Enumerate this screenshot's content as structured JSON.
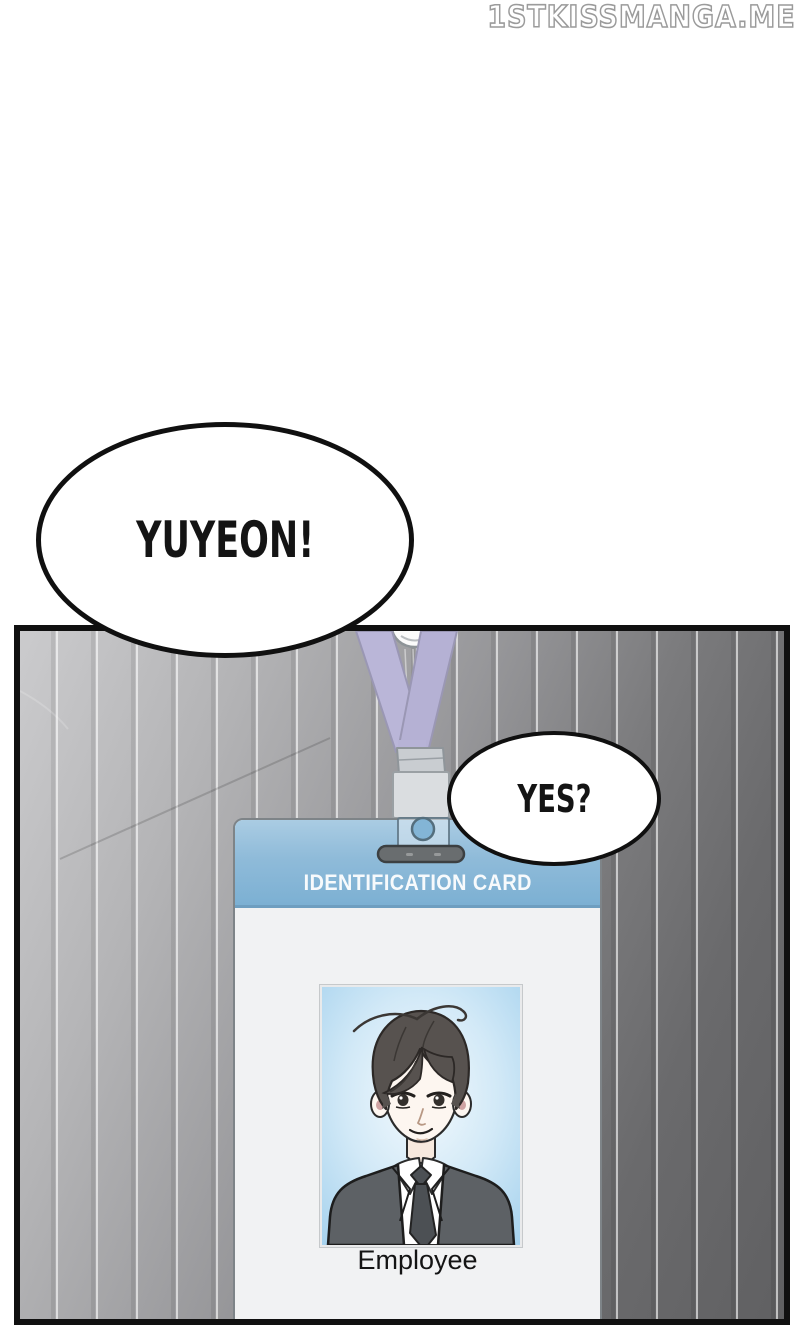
{
  "watermark": {
    "text": "1STKISSMANGA.ME"
  },
  "bubbles": {
    "yuyeon": "YUYEON!",
    "yes": "YES?"
  },
  "id_card": {
    "title": "IDENTIFICATION CARD",
    "holder_label": "Employee"
  },
  "colors": {
    "panel_border": "#101010",
    "suit_gradient_light": "#cbcbcd",
    "suit_gradient_dark": "#606062",
    "pinstripe": "#ffffff",
    "lanyard_lavender": "#b9b5d8",
    "clip_gray": "#dadde0",
    "slot_bar_gray": "#696d6f",
    "card_header_blue": "#7cb0d3",
    "card_body": "#f1f2f3",
    "photo_background_blue": "#a4d1ed",
    "bubble_fill": "#ffffff"
  }
}
